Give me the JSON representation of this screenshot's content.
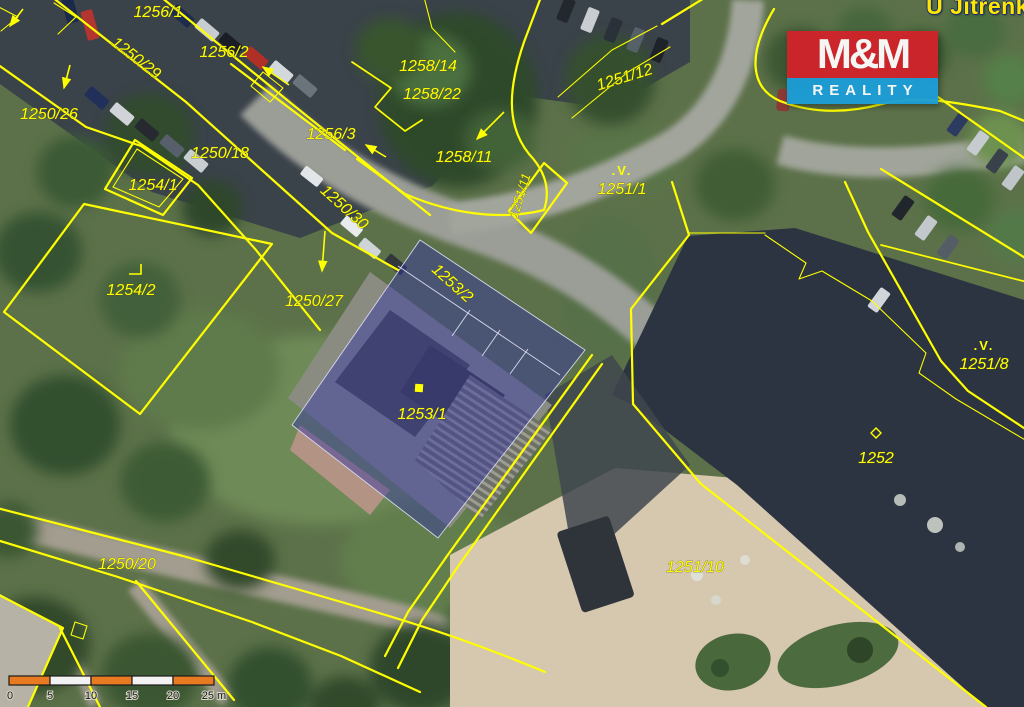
{
  "map": {
    "street_label": "U Jitřenk",
    "logo": {
      "top": "M&M",
      "bottom": "REALITY"
    },
    "symbols": {
      "land_use_mark": ".V."
    },
    "highlight": {
      "parcel": "1253/1"
    },
    "parcels": [
      {
        "label": "1256/1"
      },
      {
        "label": "1250/29"
      },
      {
        "label": "1256/2"
      },
      {
        "label": "1250/26"
      },
      {
        "label": "1258/14"
      },
      {
        "label": "1258/22"
      },
      {
        "label": "1256/3"
      },
      {
        "label": "1250/18"
      },
      {
        "label": "1258/11"
      },
      {
        "label": "1254/1"
      },
      {
        "label": "1251/12"
      },
      {
        "label": "1250/30"
      },
      {
        "label": "1251/11"
      },
      {
        "label": "1251/1"
      },
      {
        "label": "1254/2"
      },
      {
        "label": "1250/27"
      },
      {
        "label": "1253/2"
      },
      {
        "label": "1253/1"
      },
      {
        "label": "1251/8"
      },
      {
        "label": "1252"
      },
      {
        "label": "1250/20"
      },
      {
        "label": "1251/10"
      }
    ],
    "scale_bar": {
      "ticks": [
        "0",
        "5",
        "10",
        "15",
        "20",
        "25 m"
      ]
    }
  },
  "colors": {
    "line_yellow": "#ffff00",
    "label_yellow": "#ffff00",
    "street_yellow": "#ffe600",
    "logo_red": "#d2232a",
    "logo_blue": "#1b9ed9",
    "highlight_fill": "#3434a4",
    "scale_orange": "#e87b22"
  }
}
